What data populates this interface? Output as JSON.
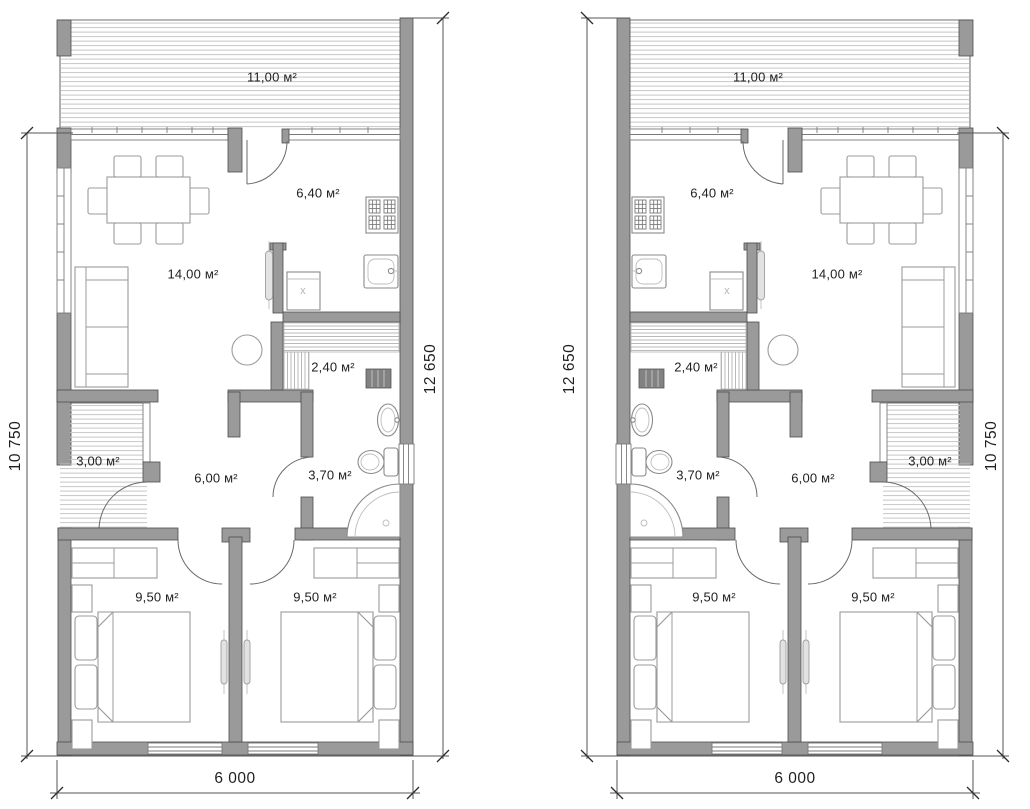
{
  "plans": [
    {
      "name": "left-unit",
      "rooms": {
        "terrace": "11,00 м²",
        "kitchen": "6,40 м²",
        "living": "14,00 м²",
        "sauna": "2,40 м²",
        "porch": "3,00 м²",
        "hall": "6,00 м²",
        "bath": "3,70 м²",
        "bedroom1": "9,50 м²",
        "bedroom2": "9,50 м²"
      },
      "appliances": {
        "washer": "x"
      },
      "dims": {
        "left": "10 750",
        "right": "12 650",
        "bottom": "6 000"
      }
    },
    {
      "name": "right-unit",
      "rooms": {
        "terrace": "11,00 м²",
        "kitchen": "6,40 м²",
        "living": "14,00 м²",
        "sauna": "2,40 м²",
        "porch": "3,00 м²",
        "hall": "6,00 м²",
        "bath": "3,70 м²",
        "bedroom1": "9,50 м²",
        "bedroom2": "9,50 м²"
      },
      "appliances": {
        "washer": "x"
      },
      "dims": {
        "left": "12 650",
        "right": "10 750",
        "bottom": "6 000"
      }
    }
  ],
  "colors": {
    "background": "#ffffff",
    "wall_fill": "#9a9a9a",
    "wall_outline": "#4d4d4d",
    "hatch_line": "#c6c6c6",
    "dimension_line": "#555555",
    "text": "#1f1f1f"
  }
}
